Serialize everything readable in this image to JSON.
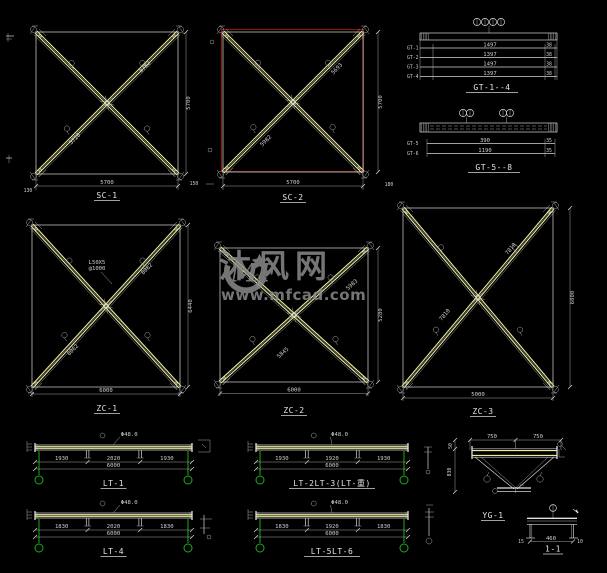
{
  "watermark": {
    "brand": "沐风网",
    "site": "www.mfcad.com",
    "logo": "MF"
  },
  "colors": {
    "background": "#000000",
    "member_yellow": "#ecec9e",
    "line_white": "#d6d6d6",
    "frame_red": "#8d1710",
    "post_green": "#16b016",
    "watermark_gray": "#8f8f8f"
  },
  "drawings": {
    "sc1": {
      "label": "SC-1",
      "dim_bottom": "5700",
      "dim_right": "5700",
      "off_left": "130",
      "off_right": "150",
      "diag_a": "5782",
      "diag_b": "5720"
    },
    "sc2": {
      "label": "SC-2",
      "dim_bottom": "5700",
      "dim_right": "5700",
      "off_right": "180",
      "diag_a": "5693",
      "diag_b": "5982"
    },
    "gt14": {
      "label": "GT-1--4",
      "rows": [
        {
          "name": "GT-1",
          "len": "1497",
          "end": "38"
        },
        {
          "name": "GT-2",
          "len": "1397",
          "end": "38"
        },
        {
          "name": "GT-3",
          "len": "1497",
          "end": "38"
        },
        {
          "name": "GT-4",
          "len": "1397",
          "end": "38"
        }
      ]
    },
    "gt58": {
      "label": "GT-5--8",
      "rows": [
        {
          "name": "GT-5",
          "len": "390",
          "end": "35"
        },
        {
          "name": "GT-6",
          "len": "1190",
          "end": "35"
        }
      ]
    },
    "zc1": {
      "label": "ZC-1",
      "dim_bottom": "6000",
      "dim_right": "6440",
      "note_l1": "L50X5",
      "note_l2": "@1000",
      "diag_a": "8082",
      "diag_b": "8062"
    },
    "zc2": {
      "label": "ZC-2",
      "dim_bottom": "6000",
      "dim_right": "5280",
      "diag_a": "5983",
      "diag_b": "5845"
    },
    "zc3": {
      "label": "ZC-3",
      "dim_bottom": "5000",
      "dim_right": "6000",
      "diag_a": "7810",
      "diag_b": "7810"
    },
    "lt1": {
      "label": "LT-1",
      "segs": [
        "1930",
        "2020",
        "1930"
      ],
      "total": "6000",
      "note": "Φ48.0"
    },
    "lt23": {
      "label": "LT-2LT-3(LT-重)",
      "segs": [
        "1930",
        "1920",
        "1930"
      ],
      "total": "6000",
      "note": "Φ48.0"
    },
    "lt4": {
      "label": "LT-4",
      "segs": [
        "1830",
        "2020",
        "1830"
      ],
      "total": "6000",
      "note": "Φ48.0"
    },
    "lt56": {
      "label": "LT-5LT-6",
      "segs": [
        "1830",
        "1920",
        "1830"
      ],
      "total": "6000",
      "note": "Φ48.0"
    },
    "yg1": {
      "label": "YG-1",
      "d1": "750",
      "d2": "750",
      "h": "830",
      "t": "50"
    },
    "sec11": {
      "label": "1-1",
      "w": "460",
      "e1": "15",
      "e2": "10"
    }
  }
}
